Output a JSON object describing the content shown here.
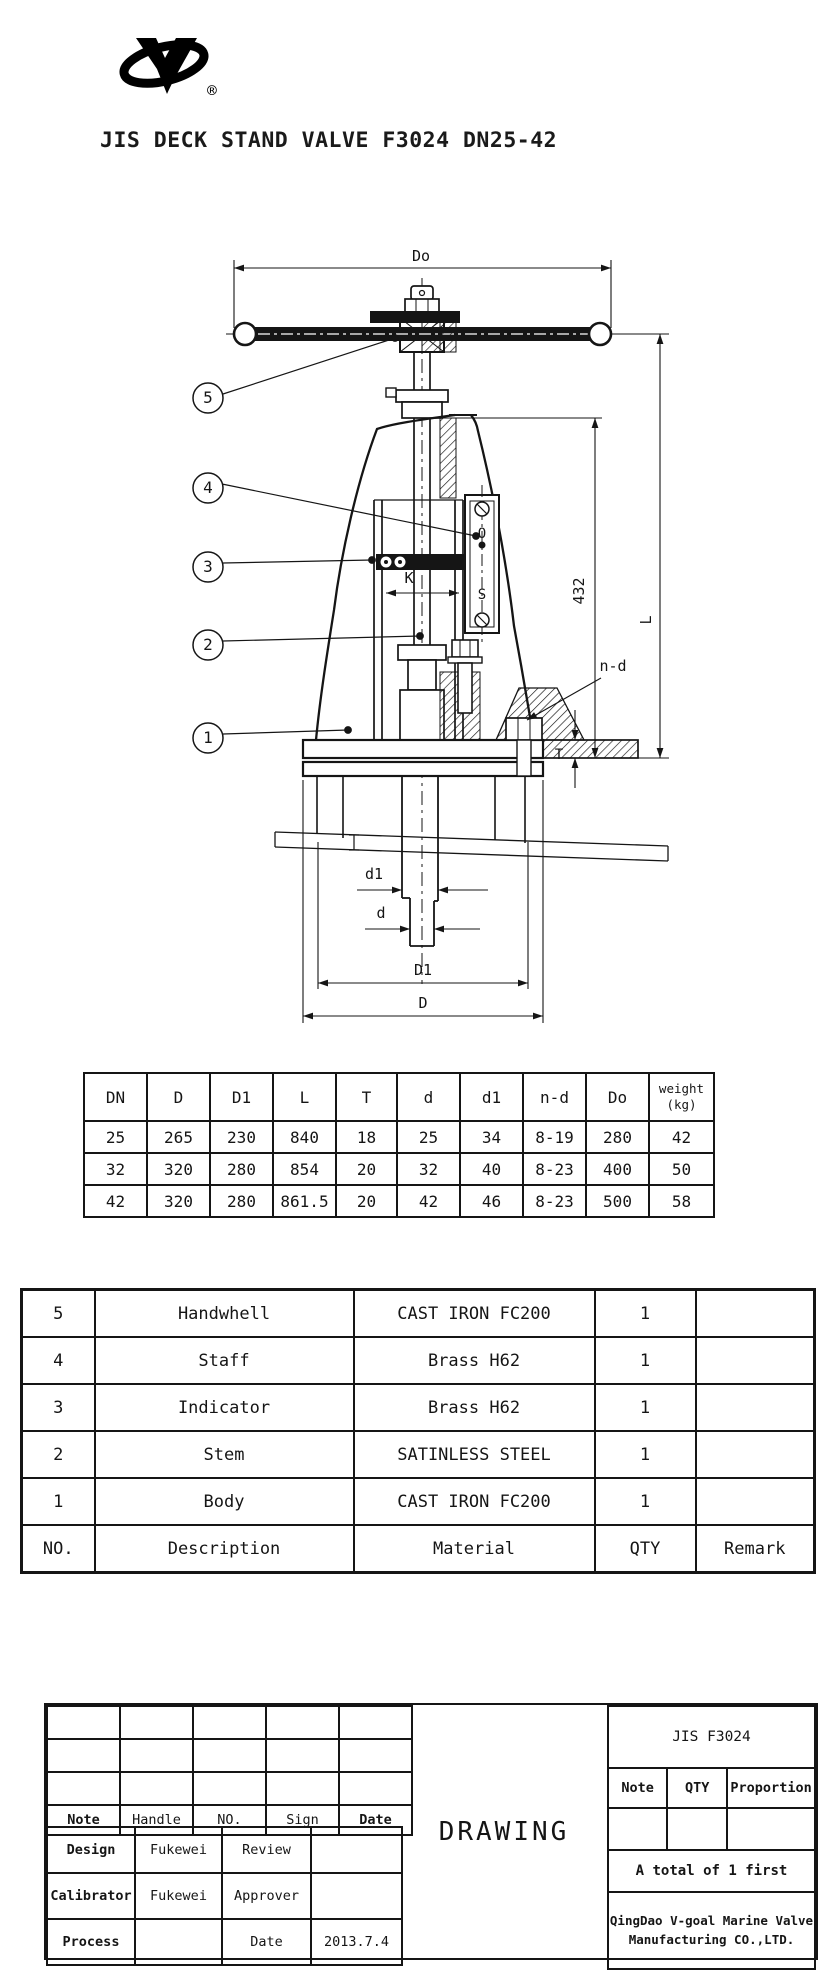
{
  "brand": {
    "registered": "®"
  },
  "title": "JIS DECK STAND VALVE F3024 DN25-42",
  "drawing": {
    "labels": {
      "do": "Do",
      "height_432": "432",
      "total_height": "L",
      "k": "K",
      "n_d": "n-d",
      "t": "T",
      "d1": "d1",
      "d": "d",
      "big_d1": "D1",
      "big_d": "D"
    },
    "indicator": {
      "open": "O",
      "shut": "S"
    },
    "callouts": [
      "1",
      "2",
      "3",
      "4",
      "5"
    ]
  },
  "dim_table": {
    "headers": [
      "DN",
      "D",
      "D1",
      "L",
      "T",
      "d",
      "d1",
      "n-d",
      "Do"
    ],
    "weight_header": [
      "weight",
      "(kg)"
    ],
    "rows": [
      [
        "25",
        "265",
        "230",
        "840",
        "18",
        "25",
        "34",
        "8-19",
        "280",
        "42"
      ],
      [
        "32",
        "320",
        "280",
        "854",
        "20",
        "32",
        "40",
        "8-23",
        "400",
        "50"
      ],
      [
        "42",
        "320",
        "280",
        "861.5",
        "20",
        "42",
        "46",
        "8-23",
        "500",
        "58"
      ]
    ]
  },
  "parts_table": {
    "rows": [
      {
        "no": "5",
        "description": "Handwhell",
        "material": "CAST IRON FC200",
        "qty": "1",
        "remark": ""
      },
      {
        "no": "4",
        "description": "Staff",
        "material": "Brass H62",
        "qty": "1",
        "remark": ""
      },
      {
        "no": "3",
        "description": "Indicator",
        "material": "Brass H62",
        "qty": "1",
        "remark": ""
      },
      {
        "no": "2",
        "description": "Stem",
        "material": "SATINLESS STEEL",
        "qty": "1",
        "remark": ""
      },
      {
        "no": "1",
        "description": "Body",
        "material": "CAST IRON FC200",
        "qty": "1",
        "remark": ""
      }
    ],
    "footer": {
      "no": "NO.",
      "description": "Description",
      "material": "Material",
      "qty": "QTY",
      "remark": "Remark"
    }
  },
  "title_block": {
    "header_row": {
      "note": "Note",
      "handle": "Handle",
      "no": "NO.",
      "sign": "Sign",
      "date": "Date"
    },
    "design": {
      "label": "Design",
      "value": "Fukewei"
    },
    "review": {
      "label": "Review",
      "value": ""
    },
    "calibrator": {
      "label": "Calibrator",
      "value": "Fukewei"
    },
    "approver": {
      "label": "Approver",
      "value": ""
    },
    "process": {
      "label": "Process",
      "value": ""
    },
    "date": {
      "label": "Date",
      "value": "2013.7.4"
    },
    "drawing_label": "DRAWING",
    "right": {
      "model": "JIS F3024",
      "note": "Note",
      "qty": "QTY",
      "proportion": "Proportion",
      "total": "A total of 1 first",
      "company_line1": "QingDao V-goal Marine Valve",
      "company_line2": "Manufacturing CO.,LTD."
    }
  }
}
